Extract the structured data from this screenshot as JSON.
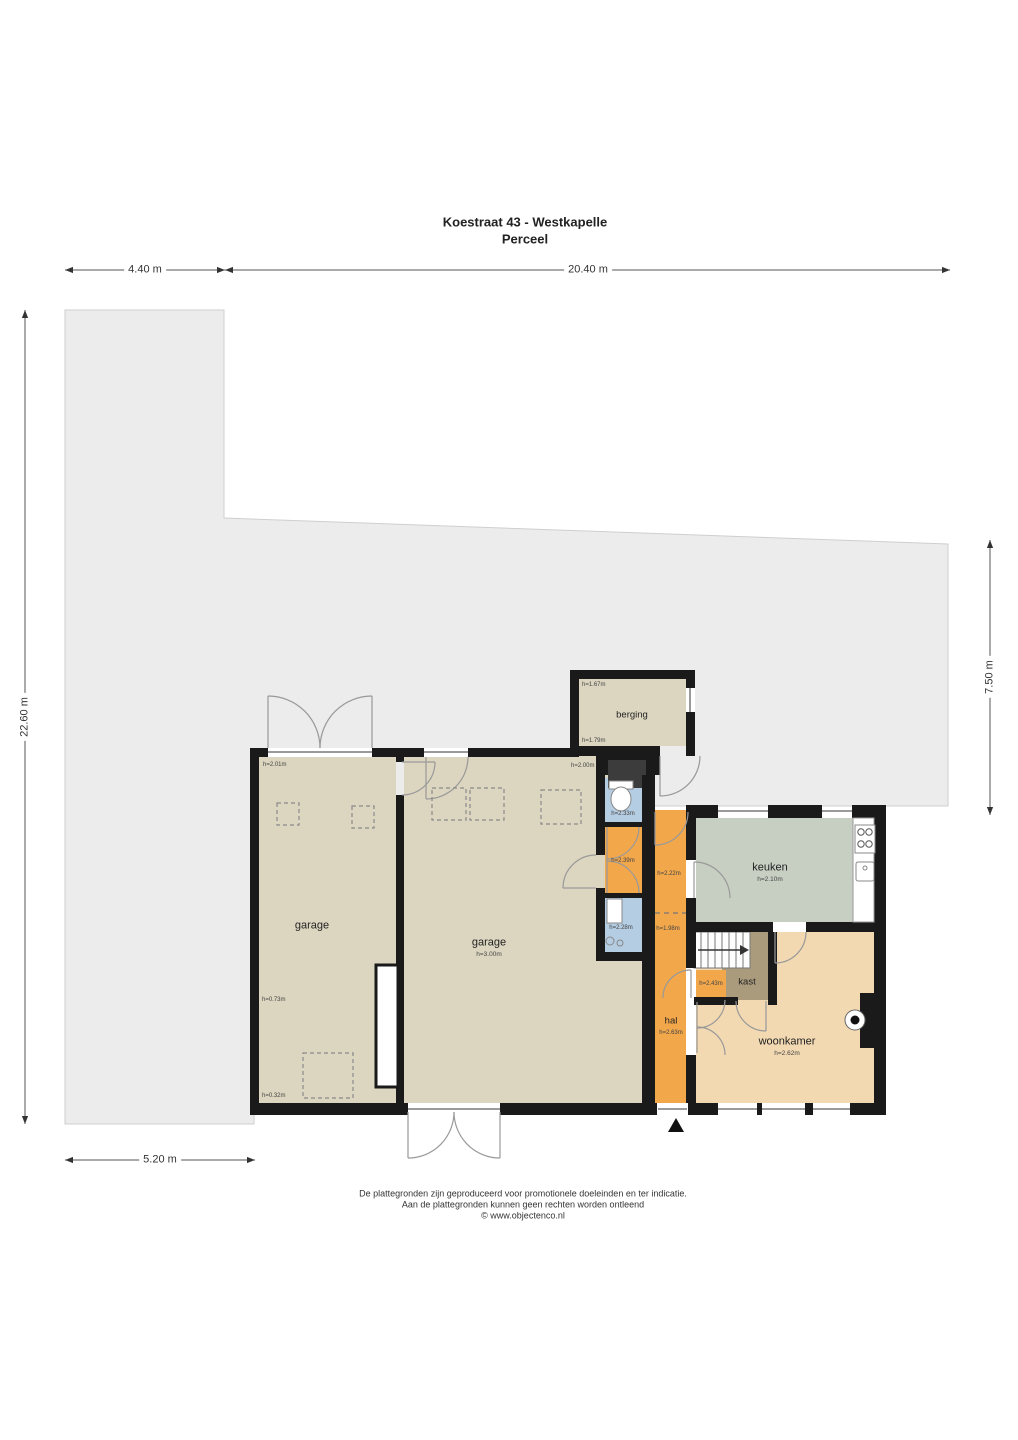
{
  "title": {
    "line1": "Koestraat 43 - Westkapelle",
    "line2": "Perceel"
  },
  "dimensions": {
    "top_left": "4.40 m",
    "top_right": "20.40 m",
    "left_side": "22.60 m",
    "right_side": "7.50 m",
    "bottom_left": "5.20 m"
  },
  "rooms": {
    "berging": {
      "label": "berging",
      "height_top": "h=1.67m",
      "height_bottom": "h=1.79m"
    },
    "entry": {
      "height": "h=2.00m"
    },
    "toilet": {
      "height": "h=2.33m"
    },
    "portaal": {
      "height": "h=2.39m"
    },
    "badkamer": {
      "height": "h=2.28m"
    },
    "hal": {
      "label": "hal",
      "height": "h=2.63m",
      "height_top": "h=2.22m",
      "height_mid": "h=1.98m"
    },
    "keuken": {
      "label": "keuken",
      "height": "h=2.10m"
    },
    "woonkamer": {
      "label": "woonkamer",
      "height": "h=2.62m"
    },
    "kast": {
      "label": "kast"
    },
    "trapkast": {
      "height": "h=2.43m"
    },
    "garage_left": {
      "label": "garage",
      "height_topleft": "h=2.01m",
      "height_left": "h=0.73m",
      "height_bottomleft": "h=0.32m"
    },
    "garage_main": {
      "label": "garage",
      "height": "h=3.00m"
    }
  },
  "footer": {
    "line1": "De plattegronden zijn geproduceerd voor promotionele doeleinden en ter indicatie.",
    "line2": "Aan de plattegronden kunnen geen rechten worden ontleend",
    "line3": "© www.objectenco.nl"
  },
  "colors": {
    "wall": "#1a1a1a",
    "parcel": "#ececec",
    "room_beige": "#dcd6c0",
    "room_orange": "#f2a74b",
    "room_blue": "#b5cde2",
    "room_green": "#c7cfc3",
    "room_tan": "#f2d9b2",
    "room_brown": "#ab9b7d"
  }
}
